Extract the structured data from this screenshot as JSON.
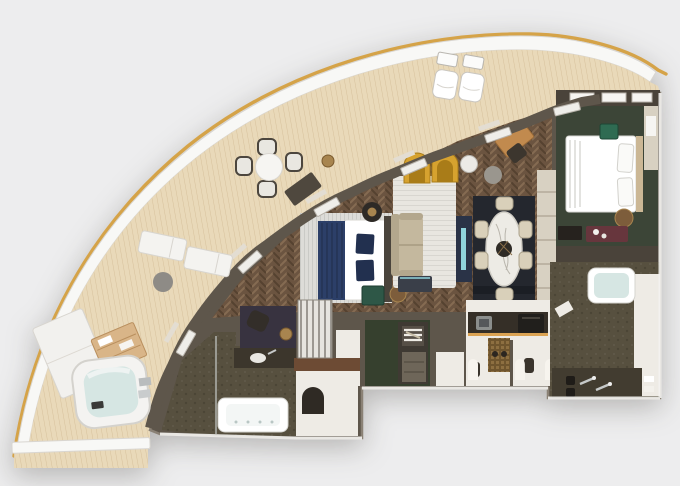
{
  "image": {
    "kind": "rendered-floor-plan",
    "label": "Top-down 3D floor plan of a curved luxury suite with wrap-around balcony",
    "visible_text": [],
    "palette": {
      "bg": "#ededee",
      "hullGold": "#d5a348",
      "rimWhite": "#f8f8f6",
      "rimLine": "#d9d6d1",
      "deck": "#e9d9b9",
      "wall": "#5e564b",
      "wallDark": "#4a433a",
      "wallLight": "#8a8175",
      "wood": "#6b5440",
      "greenRoom": "#3c4537",
      "greenCloset": "#36402e",
      "rugDining": "#24272e",
      "rugWhite": "#e8e6e0",
      "stone": "#57503f",
      "stoneDark": "#423c30",
      "whiteFloor": "#eeebe5",
      "navy": "#2c3f68",
      "navyDark": "#22304f",
      "yellow": "#d6a22f",
      "yellowDark": "#a97c18",
      "sofa": "#c4b89e",
      "deskWood": "#c18a4e",
      "marble": "#edebe5",
      "chairCream": "#d9d0ba",
      "teal": "#2f6b52",
      "maroon": "#67363d",
      "bronze": "#7d5d3b",
      "bronzeHi": "#a8854f",
      "water": "#d6e6e3",
      "chrome": "#c6c9c9",
      "charcoal": "#383340",
      "panel": "#a9a49b",
      "corridor": "#d8d1c2",
      "mosaicGold": "#8d6f41",
      "counter": "#352f27",
      "glow": "#dba353",
      "tvNavy": "#2a3347",
      "cyan": "#8fd4dc",
      "white": "#f6f5f2",
      "black": "#26221e"
    },
    "regions": {
      "balcony": {
        "label": "Curved private balcony deck",
        "items": [
          "round bistro table with four chairs",
          "two deck chairs with side tables",
          "two sun loungers with side table",
          "double daybed",
          "towel shelf",
          "whirlpool hot tub",
          "privacy divider wall"
        ]
      },
      "living_room": {
        "label": "Living room with herringbone wood floor",
        "items": [
          "two yellow arch armchairs",
          "white striped rug",
          "beige sofa",
          "drum side table",
          "media wall",
          "bar cabinet",
          "writing desk with chair",
          "floor lamp"
        ]
      },
      "master_bedroom": {
        "label": "Master sleeping area",
        "items": [
          "bed with navy throw and pillows",
          "round side table with lamp",
          "green marble nightstand",
          "bench with navy cushion",
          "bronze pouf"
        ]
      },
      "dining_area": {
        "label": "Dining area",
        "items": [
          "oval marble dining table",
          "six cream chairs",
          "dark area rug"
        ]
      },
      "second_bedroom": {
        "label": "Second bedroom with green carpet",
        "items": [
          "double bed with white linens",
          "plant box",
          "bronze pouf",
          "shelf niche",
          "maroon dresser with flowers",
          "tv cabinet"
        ]
      },
      "bathroom_right": {
        "label": "En-suite bathroom",
        "items": [
          "bathtub",
          "double-sink vanity",
          "towels"
        ]
      },
      "bathroom_left": {
        "label": "Master bathroom",
        "items": [
          "bathtub with jets",
          "vanity with sink",
          "arched doorway",
          "vanity nook with chair and lamp"
        ]
      },
      "toilet_rooms": {
        "label": "Twin water closets with gold mosaic wall",
        "items": [
          "toilet left",
          "toilet right",
          "arched niches"
        ]
      },
      "pantry": {
        "label": "Pantry bar",
        "items": [
          "counter with under-lighting",
          "sink",
          "coffee machine"
        ]
      },
      "closet": {
        "label": "Walk-in wardrobe",
        "items": [
          "hanging clothes",
          "drawer unit"
        ]
      },
      "corridor": {
        "label": "Wardrobe corridor",
        "items": [
          "sliding doors"
        ]
      }
    }
  }
}
